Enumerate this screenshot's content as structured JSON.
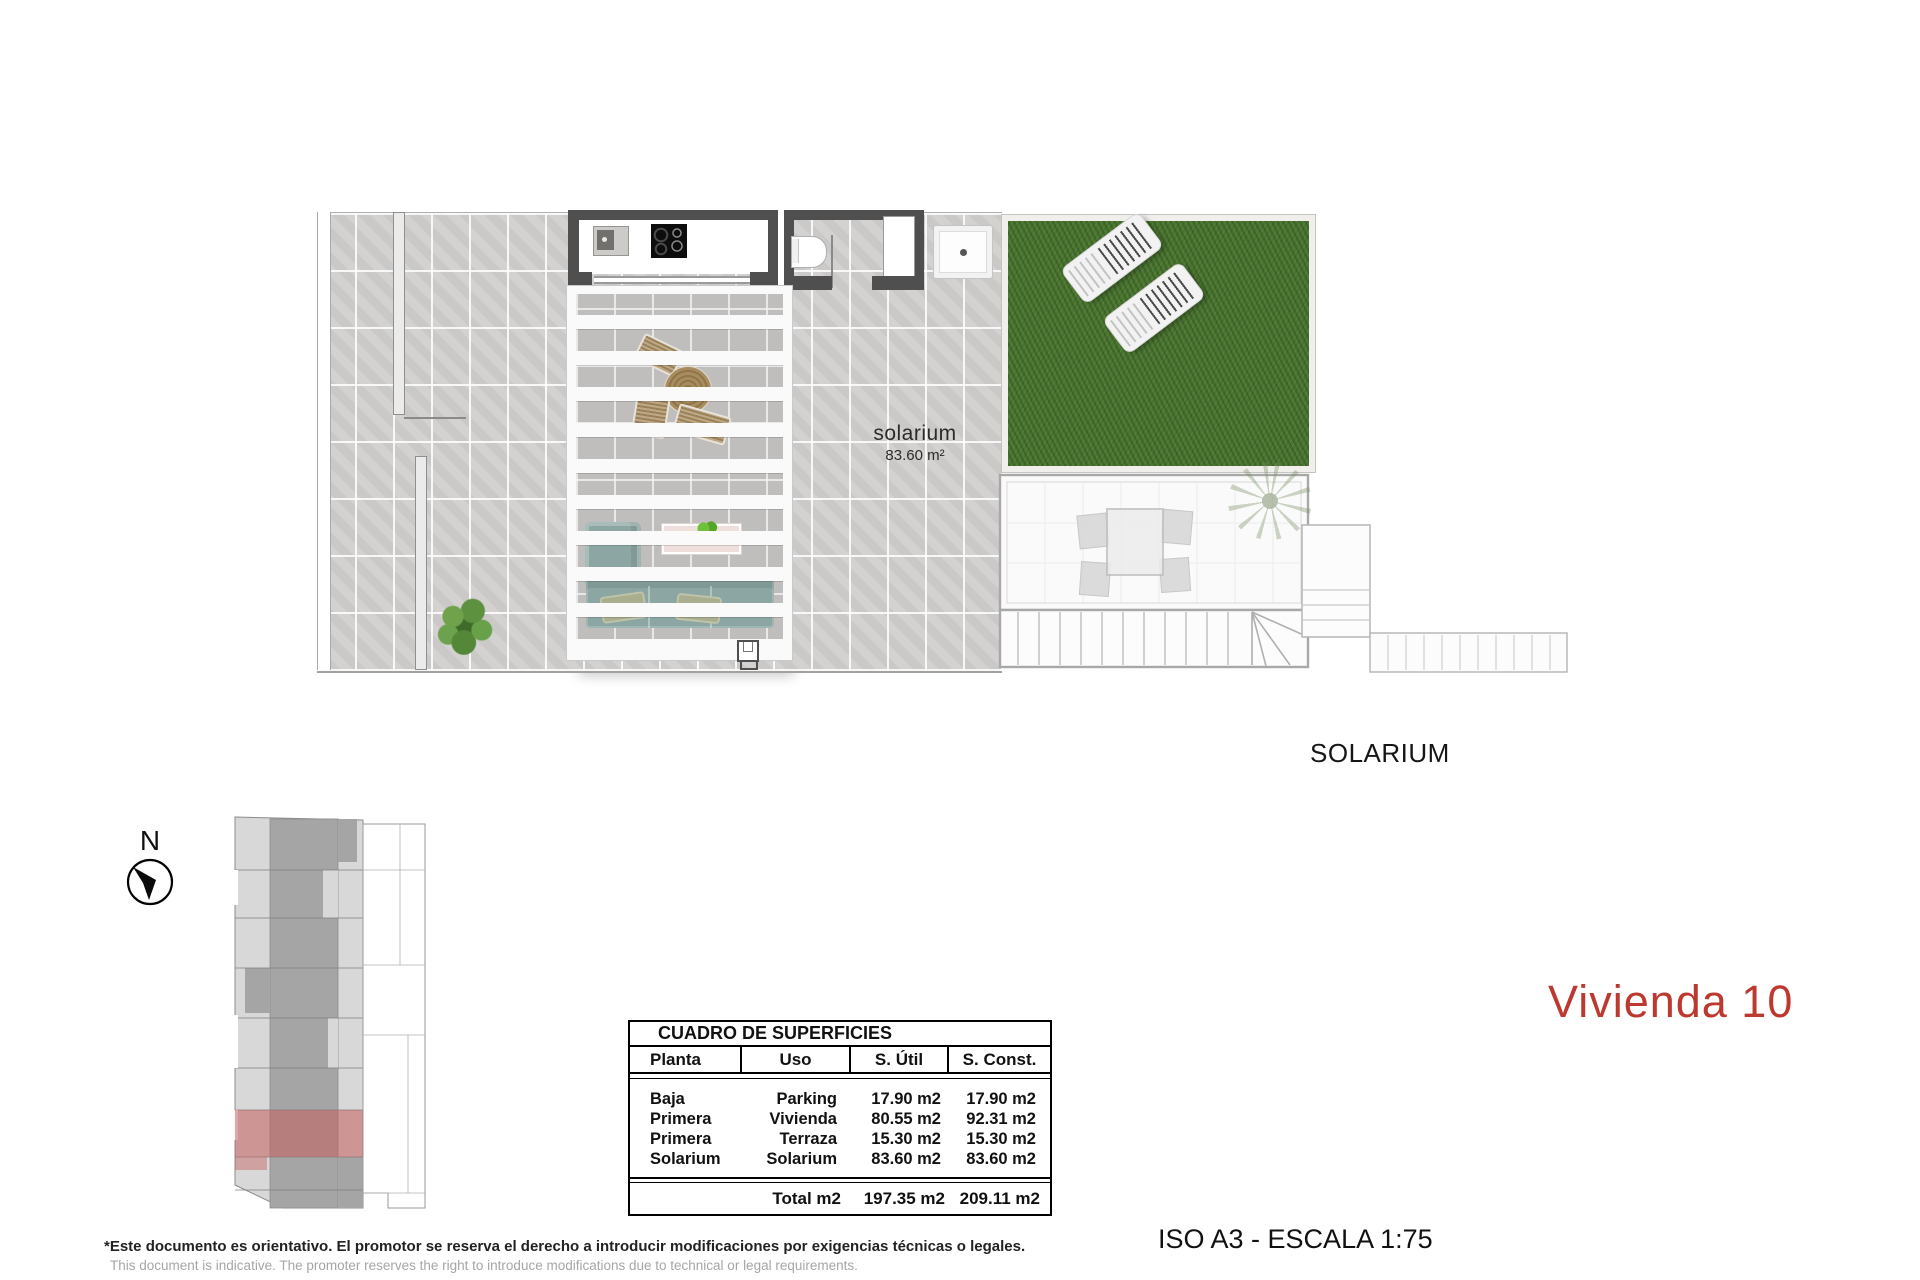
{
  "title": {
    "unit_label": "Vivienda 10",
    "scale_label": "ISO A3 - ESCALA 1:75"
  },
  "plan": {
    "section_label": "SOLARIUM",
    "room_label": "solarium",
    "room_area": "83.60 m²"
  },
  "compass": {
    "north_label": "N"
  },
  "surfaces_table": {
    "title": "CUADRO DE SUPERFICIES",
    "headers": [
      "Planta",
      "Uso",
      "S. Útil",
      "S. Const."
    ],
    "rows": [
      {
        "planta": "Baja",
        "uso": "Parking",
        "util": "17.90 m2",
        "const": "17.90 m2"
      },
      {
        "planta": "Primera",
        "uso": "Vivienda",
        "util": "80.55 m2",
        "const": "92.31 m2"
      },
      {
        "planta": "Primera",
        "uso": "Terraza",
        "util": "15.30 m2",
        "const": "15.30 m2"
      },
      {
        "planta": "Solarium",
        "uso": "Solarium",
        "util": "83.60 m2",
        "const": "83.60 m2"
      }
    ],
    "total": {
      "label": "Total m2",
      "util": "197.35 m2",
      "const": "209.11 m2"
    }
  },
  "disclaimer": {
    "es": "*Este documento es orientativo. El promotor se reserva el derecho a introducir modificaciones por exigencias técnicas o legales.",
    "en": "This document is indicative. The promoter reserves the right to introduce modifications due to technical or legal requirements."
  },
  "colors": {
    "accent_red": "#bd382e",
    "highlight_red": "rgba(198,95,95,0.55)",
    "grass_green": "#4a7431",
    "tile_gray": "#d2d0ce",
    "wall_dark": "#4f4f4f"
  }
}
